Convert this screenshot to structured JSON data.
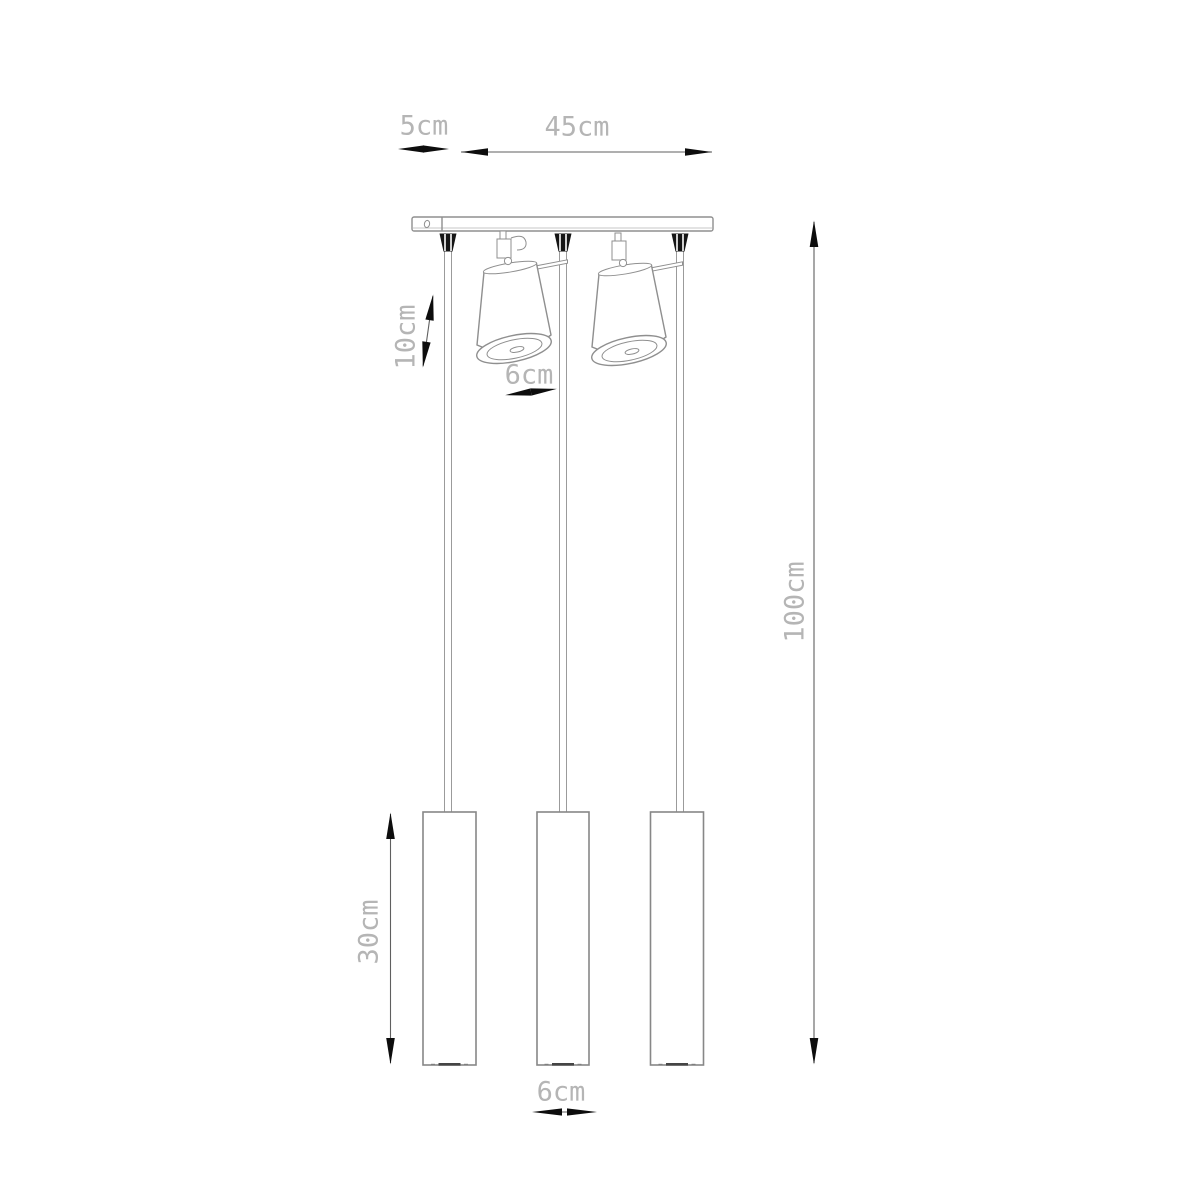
{
  "labels": {
    "canopy_offset": "5cm",
    "canopy_width": "45cm",
    "spot_length": "10cm",
    "spot_diameter": "6cm",
    "drop_height": "100cm",
    "tube_length": "30cm",
    "tube_diameter": "6cm"
  },
  "colors": {
    "outline": "#8f8f8f",
    "outline_light": "#b5b5b5",
    "dim_line": "#5f5f5f",
    "dim_text": "#b5b5b5",
    "arrow": "#0d0d0d",
    "grip": "#151515",
    "lens_dark": "#454545",
    "background": "#ffffff"
  }
}
